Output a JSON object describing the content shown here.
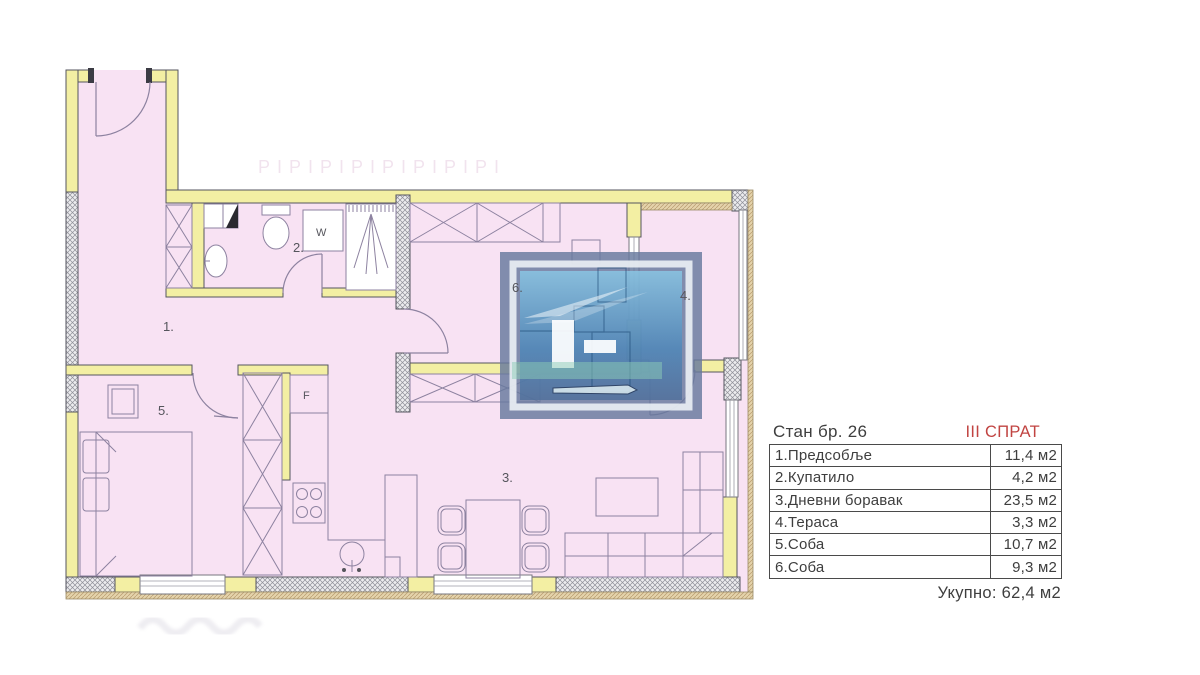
{
  "header": {
    "apartment_label": "Стан бр. 26",
    "floor_label": "III СПРАТ"
  },
  "area_table": {
    "rows": [
      {
        "name": "1.Предсобље",
        "area": "11,4 м2"
      },
      {
        "name": "2.Купатило",
        "area": "4,2 м2"
      },
      {
        "name": "3.Дневни боравак",
        "area": "23,5 м2"
      },
      {
        "name": "4.Тераса",
        "area": "3,3 м2"
      },
      {
        "name": "5.Соба",
        "area": "10,7 м2"
      },
      {
        "name": "6.Соба",
        "area": "9,3 м2"
      }
    ],
    "total": "Укупно: 62,4 м2"
  },
  "plan_labels": {
    "hallway": "1.",
    "bathroom": "2.",
    "living_room": "3.",
    "terrace": "4.",
    "bedroom": "5.",
    "room6": "6.",
    "washing_machine": "W",
    "fridge": "F"
  },
  "watermark": {
    "faint_text": "PIPIPIPIPIPIPIPI"
  },
  "colors": {
    "floor_pink": "#f8e2f3",
    "wall_yellow": "#f3efa3",
    "accent_red": "#c14442",
    "logo_slate": "#66799e",
    "logo_blue": "#4e88ba"
  }
}
